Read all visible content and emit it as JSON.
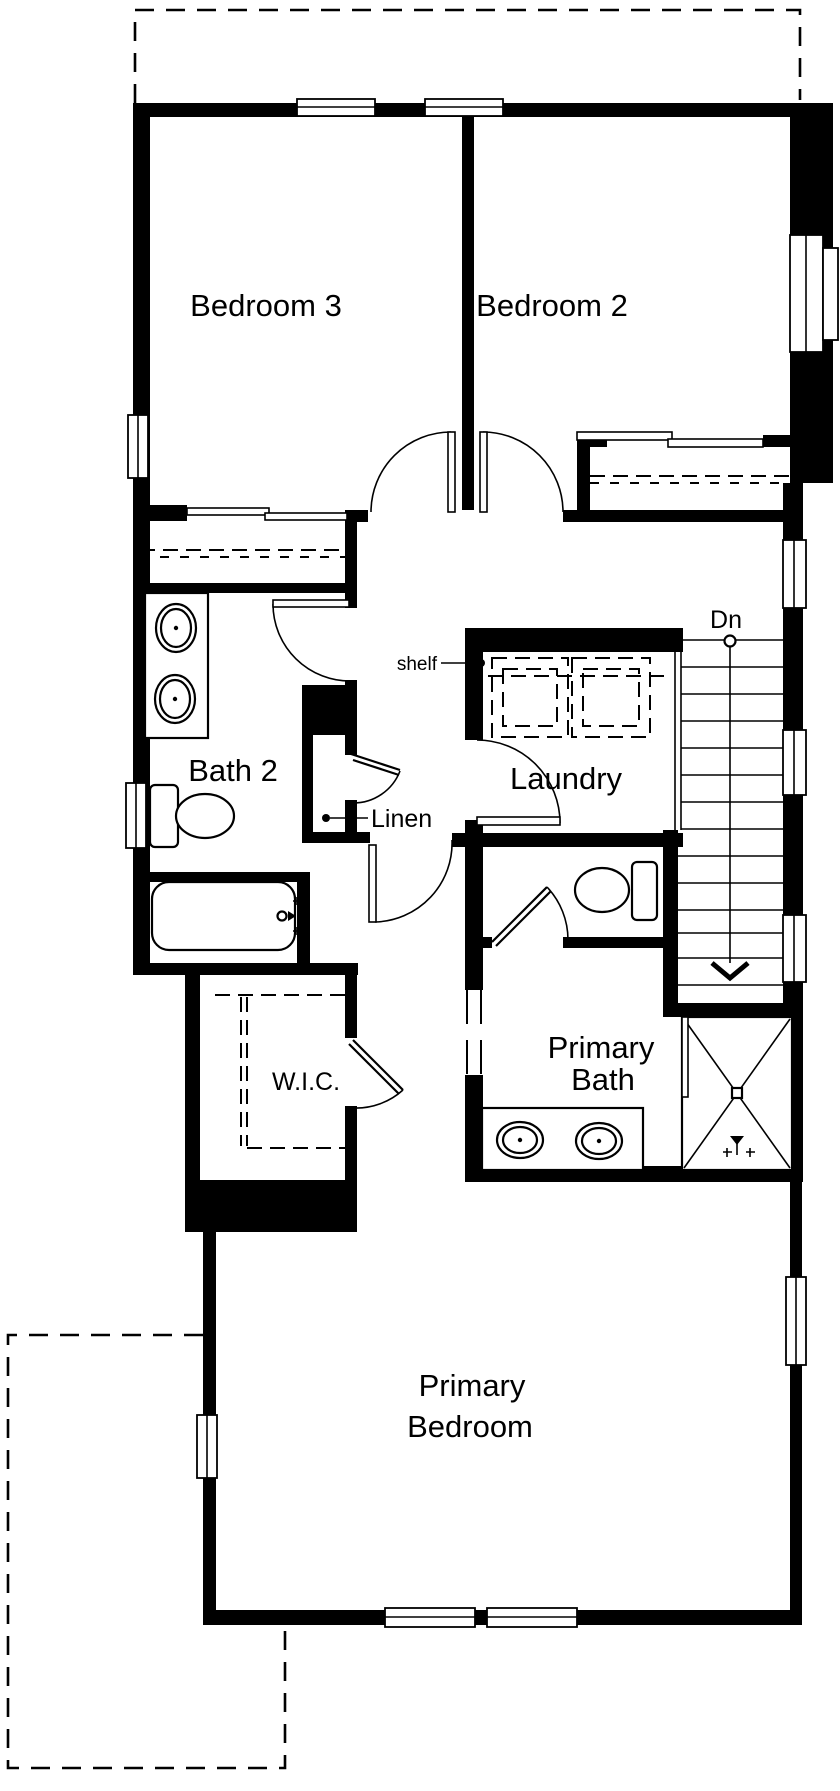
{
  "rooms": {
    "bedroom3": "Bedroom 3",
    "bedroom2": "Bedroom 2",
    "bath2": "Bath 2",
    "laundry": "Laundry",
    "wic": "W.I.C.",
    "primary_bath_line1": "Primary",
    "primary_bath_line2": "Bath",
    "primary_bedroom_line1": "Primary",
    "primary_bedroom_line2": "Bedroom"
  },
  "annotations": {
    "shelf": "shelf",
    "linen": "Linen",
    "stairs_down": "Dn"
  },
  "colors": {
    "line": "#000000",
    "background": "#ffffff"
  }
}
